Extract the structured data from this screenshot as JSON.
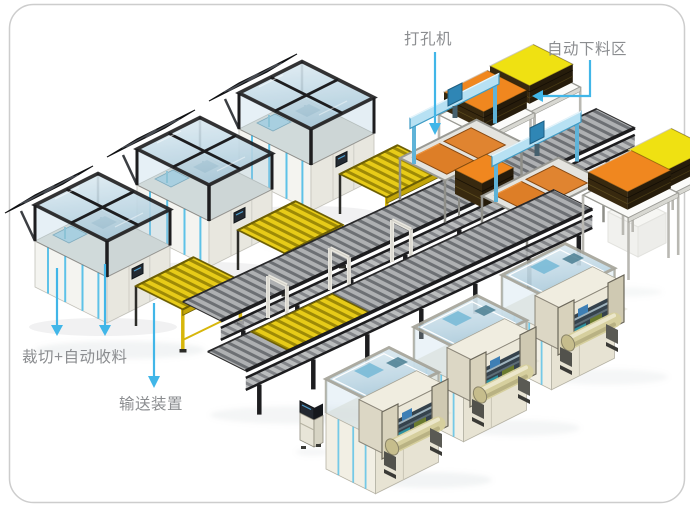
{
  "frame": {
    "background": "#ffffff",
    "border_color": "#cdcdcd"
  },
  "labels": {
    "punch_machine": "打孔机",
    "auto_unloading_area": "自动下料区",
    "cutting_auto_collection": "裁切+自动收料",
    "conveyor_device": "输送装置"
  },
  "colors": {
    "background": "#ffffff",
    "border": "#cdcdcd",
    "arrow": "#41b6e8",
    "label_text": "#8b8d90",
    "stack_orange": "#f0871f",
    "stack_yellow": "#efe112",
    "sheet_orange": "#dd7e27",
    "conveyor_yellow": "#e7cb18",
    "conveyor_yellow_dark": "#9e8a06",
    "roller_gray": "#aeb0b2",
    "roller_dark": "#6d7074",
    "frame_black": "#1d1d1f",
    "machine_white": "#f4f4f0",
    "machine_cream": "#ece8d9",
    "accent_blue": "#55c0e8",
    "gantry_blue": "#b7e1f3",
    "glass_blue": "#bdd8e6",
    "winder_roller": "#d6cf9e",
    "panel_dark": "#26282c"
  }
}
